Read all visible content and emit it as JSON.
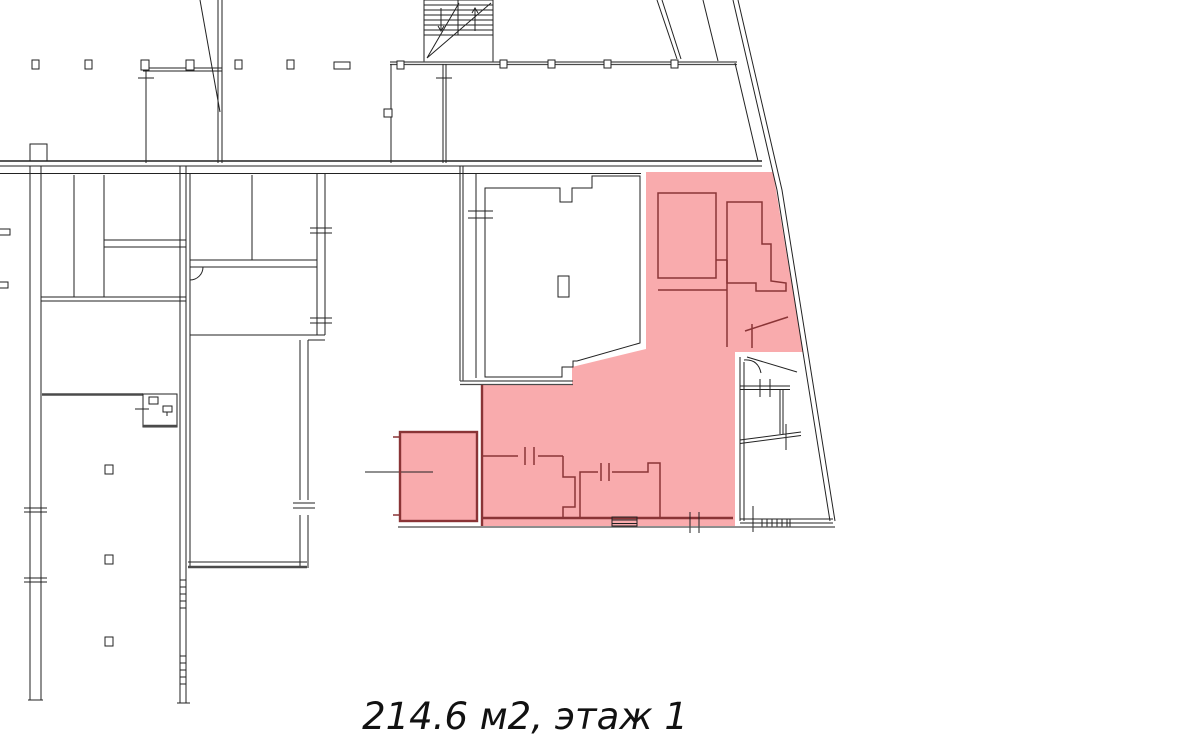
{
  "caption": {
    "text": "214.6 м2, этаж 1",
    "area": "214.6 м2",
    "floor": "этаж 1"
  },
  "colors": {
    "background": "#ffffff",
    "wall": "#222222",
    "wall_thick": "#4a4a4a",
    "highlight": "#f9abad",
    "highlight_border": "#8a3436",
    "caption_text": "#111111"
  },
  "plan": {
    "kind": "building floor plan",
    "highlighted_area_name": "highlighted-premises"
  }
}
